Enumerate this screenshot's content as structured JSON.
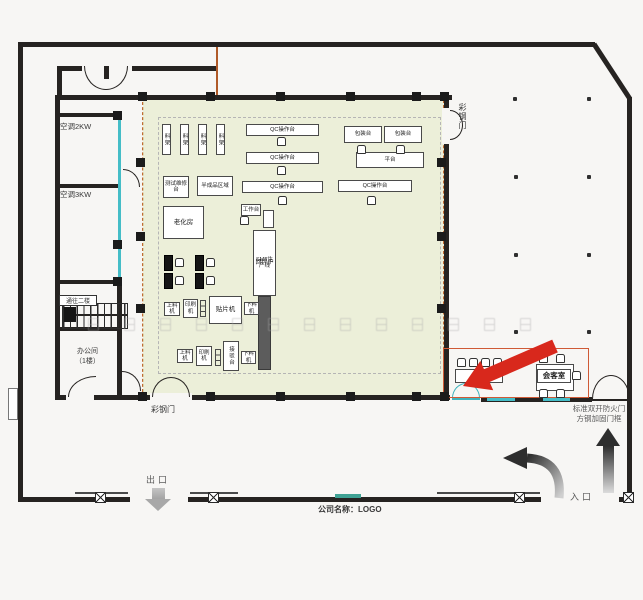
{
  "plan": {
    "labels": {
      "ac2": "空调2KW",
      "ac3": "空调3KW",
      "stairs": "通往二楼",
      "office1": "办公间",
      "office2": "（1楼）",
      "door_left": "彩钢门",
      "door_right": "彩钢门",
      "fire_note1": "标准双开防火门",
      "fire_note2": "方钢加固门框",
      "exit": "出口",
      "entrance": "入口",
      "company": "公司名称：LOGO"
    },
    "equipment": [
      {
        "label": "料架",
        "x": 162,
        "y": 124,
        "w": 9,
        "h": 31,
        "cls": "v"
      },
      {
        "label": "料架",
        "x": 180,
        "y": 124,
        "w": 9,
        "h": 31,
        "cls": "v"
      },
      {
        "label": "料架",
        "x": 198,
        "y": 124,
        "w": 9,
        "h": 31,
        "cls": "v"
      },
      {
        "label": "料架",
        "x": 216,
        "y": 124,
        "w": 9,
        "h": 31,
        "cls": "v"
      },
      {
        "label": "测试维修台",
        "x": 163,
        "y": 176,
        "w": 26,
        "h": 22,
        "cls": ""
      },
      {
        "label": "半成品区域",
        "x": 197,
        "y": 176,
        "w": 36,
        "h": 20,
        "cls": ""
      },
      {
        "label": "老化房",
        "x": 163,
        "y": 206,
        "w": 41,
        "h": 33,
        "cls": "m"
      },
      {
        "label": "QC操作台",
        "x": 246,
        "y": 124,
        "w": 73,
        "h": 12,
        "cls": ""
      },
      {
        "label": "QC操作台",
        "x": 246,
        "y": 152,
        "w": 73,
        "h": 12,
        "cls": ""
      },
      {
        "label": "QC操作台",
        "x": 242,
        "y": 181,
        "w": 81,
        "h": 12,
        "cls": ""
      },
      {
        "label": "包装台",
        "x": 344,
        "y": 126,
        "w": 38,
        "h": 17,
        "cls": ""
      },
      {
        "label": "包装台",
        "x": 384,
        "y": 126,
        "w": 38,
        "h": 17,
        "cls": ""
      },
      {
        "label": "平台",
        "x": 356,
        "y": 152,
        "w": 68,
        "h": 16,
        "cls": ""
      },
      {
        "label": "QC操作台",
        "x": 338,
        "y": 180,
        "w": 74,
        "h": 12,
        "cls": ""
      },
      {
        "label": "工作台",
        "x": 241,
        "y": 204,
        "w": 20,
        "h": 12,
        "cls": ""
      },
      {
        "label": "",
        "x": 263,
        "y": 210,
        "w": 11,
        "h": 18,
        "cls": ""
      },
      {
        "label": "回焊炉",
        "x": 253,
        "y": 230,
        "w": 23,
        "h": 66,
        "cls": "oven",
        "sub": "SMT生产线"
      },
      {
        "label": "",
        "x": 258,
        "y": 296,
        "w": 13,
        "h": 74,
        "cls": "dark"
      },
      {
        "label": "",
        "x": 164,
        "y": 255,
        "w": 9,
        "h": 16,
        "cls": "black"
      },
      {
        "label": "",
        "x": 164,
        "y": 273,
        "w": 9,
        "h": 16,
        "cls": "black"
      },
      {
        "label": "",
        "x": 195,
        "y": 255,
        "w": 9,
        "h": 16,
        "cls": "black"
      },
      {
        "label": "",
        "x": 195,
        "y": 273,
        "w": 9,
        "h": 16,
        "cls": "black"
      },
      {
        "label": "上料机",
        "x": 164,
        "y": 302,
        "w": 16,
        "h": 14,
        "cls": ""
      },
      {
        "label": "印刷机",
        "x": 183,
        "y": 299,
        "w": 15,
        "h": 19,
        "cls": ""
      },
      {
        "label": "",
        "x": 200,
        "y": 300,
        "w": 6,
        "h": 17,
        "cls": "cells"
      },
      {
        "label": "贴片机",
        "x": 209,
        "y": 296,
        "w": 33,
        "h": 28,
        "cls": "m"
      },
      {
        "label": "下料机",
        "x": 244,
        "y": 302,
        "w": 15,
        "h": 13,
        "cls": ""
      },
      {
        "label": "上料机",
        "x": 177,
        "y": 349,
        "w": 16,
        "h": 14,
        "cls": ""
      },
      {
        "label": "印刷机",
        "x": 196,
        "y": 346,
        "w": 16,
        "h": 20,
        "cls": ""
      },
      {
        "label": "",
        "x": 215,
        "y": 349,
        "w": 6,
        "h": 17,
        "cls": "cells"
      },
      {
        "label": "接驳台",
        "x": 223,
        "y": 341,
        "w": 16,
        "h": 30,
        "cls": "v"
      },
      {
        "label": "下料机",
        "x": 241,
        "y": 351,
        "w": 15,
        "h": 13,
        "cls": ""
      },
      {
        "label": "",
        "x": 455,
        "y": 369,
        "w": 24,
        "h": 14,
        "cls": ""
      },
      {
        "label": "",
        "x": 479,
        "y": 369,
        "w": 24,
        "h": 14,
        "cls": ""
      },
      {
        "label": "",
        "x": 536,
        "y": 364,
        "w": 38,
        "h": 27,
        "cls": ""
      },
      {
        "label": "会客室",
        "x": 537,
        "y": 369,
        "w": 34,
        "h": 14,
        "cls": "mlabel"
      }
    ],
    "chairs": [
      {
        "x": 277,
        "y": 137
      },
      {
        "x": 277,
        "y": 166
      },
      {
        "x": 278,
        "y": 196
      },
      {
        "x": 357,
        "y": 145
      },
      {
        "x": 396,
        "y": 145
      },
      {
        "x": 367,
        "y": 196
      },
      {
        "x": 240,
        "y": 216
      },
      {
        "x": 175,
        "y": 258
      },
      {
        "x": 175,
        "y": 276
      },
      {
        "x": 206,
        "y": 258
      },
      {
        "x": 206,
        "y": 276
      },
      {
        "x": 457,
        "y": 358
      },
      {
        "x": 469,
        "y": 358
      },
      {
        "x": 481,
        "y": 358
      },
      {
        "x": 493,
        "y": 358
      },
      {
        "x": 539,
        "y": 354
      },
      {
        "x": 556,
        "y": 354
      },
      {
        "x": 572,
        "y": 371
      },
      {
        "x": 539,
        "y": 389
      },
      {
        "x": 556,
        "y": 389
      }
    ],
    "posts": [
      {
        "x": 138,
        "y": 92
      },
      {
        "x": 206,
        "y": 92
      },
      {
        "x": 276,
        "y": 92
      },
      {
        "x": 346,
        "y": 92
      },
      {
        "x": 412,
        "y": 92
      },
      {
        "x": 440,
        "y": 92
      },
      {
        "x": 138,
        "y": 392
      },
      {
        "x": 206,
        "y": 392
      },
      {
        "x": 276,
        "y": 392
      },
      {
        "x": 346,
        "y": 392
      },
      {
        "x": 412,
        "y": 392
      },
      {
        "x": 440,
        "y": 392
      },
      {
        "x": 136,
        "y": 158
      },
      {
        "x": 136,
        "y": 232
      },
      {
        "x": 136,
        "y": 304
      },
      {
        "x": 437,
        "y": 158
      },
      {
        "x": 437,
        "y": 232
      },
      {
        "x": 437,
        "y": 304
      },
      {
        "x": 113,
        "y": 111
      },
      {
        "x": 113,
        "y": 240
      },
      {
        "x": 113,
        "y": 277
      }
    ],
    "gateposts": [
      {
        "x": 95,
        "y": 492
      },
      {
        "x": 208,
        "y": 492
      },
      {
        "x": 514,
        "y": 492
      },
      {
        "x": 623,
        "y": 492
      }
    ],
    "dots": [
      {
        "x": 513,
        "y": 97
      },
      {
        "x": 587,
        "y": 97
      },
      {
        "x": 514,
        "y": 175
      },
      {
        "x": 587,
        "y": 175
      },
      {
        "x": 514,
        "y": 253
      },
      {
        "x": 587,
        "y": 253
      },
      {
        "x": 514,
        "y": 330
      },
      {
        "x": 587,
        "y": 330
      }
    ],
    "watermark_row": {
      "y": 318,
      "x_start": 88,
      "step": 36,
      "count": 13
    }
  },
  "colors": {
    "wall": "#262321",
    "production_fill": "#ecefd9",
    "accent_cyan": "#45bdc7",
    "accent_orange": "#c06a32",
    "meeting_outline": "#cf5a36",
    "red_arrow": "#d8281c",
    "teal_gate": "#3fa294"
  },
  "icons": {
    "red_arrow": "red-direction-arrow",
    "entrance_up_arrow": "entrance-up-arrow",
    "exit_down_arrow": "exit-down-arrow",
    "turn_left_arrow": "curved-turn-arrow"
  }
}
